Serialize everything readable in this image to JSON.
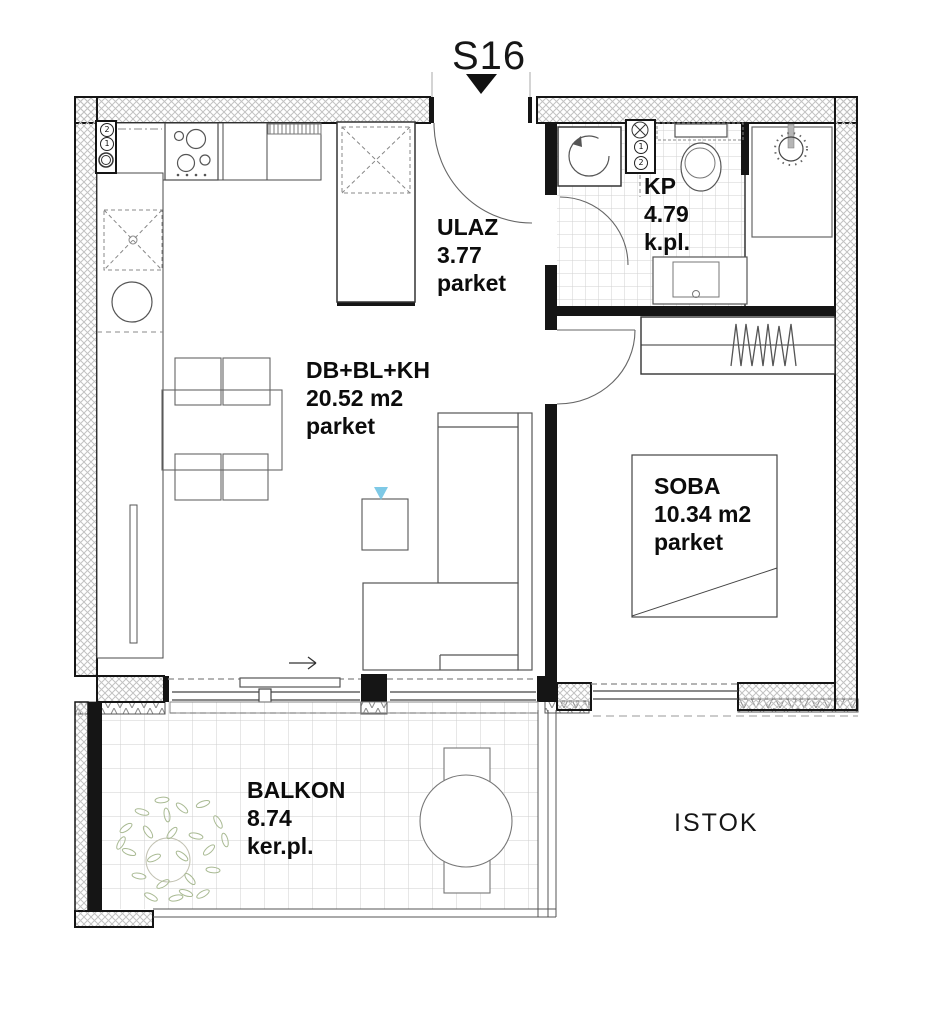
{
  "unit_label": "S16",
  "orientation_label": "ISTOK",
  "rooms": {
    "ulaz": {
      "name": "ULAZ",
      "area": "3.77",
      "floor": "parket"
    },
    "kp": {
      "name": "KP",
      "area": "4.79",
      "floor": "k.pl."
    },
    "living": {
      "name": "DB+BL+KH",
      "area": "20.52 m2",
      "floor": "parket"
    },
    "soba": {
      "name": "SOBA",
      "area": "10.34 m2",
      "floor": "parket"
    },
    "balkon": {
      "name": "BALKON",
      "area": "8.74",
      "floor": "ker.pl."
    }
  },
  "shaft_labels": {
    "kitchen_top": "2",
    "kitchen_mid": "1",
    "bath_mid": "1",
    "bath_bottom": "2"
  },
  "colors": {
    "line_black": "#151515",
    "wall_hatch": "#c2c2c2",
    "tile_grid": "#d2d2d2",
    "accent_blue": "#7ec9e6",
    "plant_green": "#a9ba93"
  }
}
